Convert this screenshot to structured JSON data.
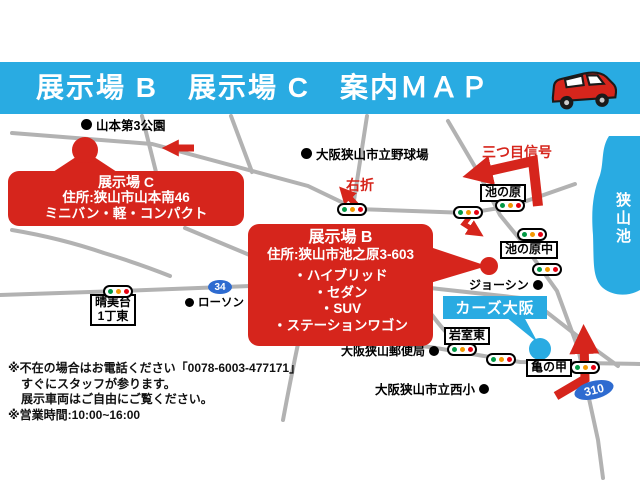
{
  "colors": {
    "brand_blue": "#29abe2",
    "map_red": "#d6251c",
    "road_gray": "#b2b2b2",
    "badge_blue": "#2e6bd0"
  },
  "header": {
    "title": "展示場 B　展示場 C　案内ＭＡＰ"
  },
  "callouts": {
    "c": {
      "title": "展示場 C",
      "address": "住所:狭山市山本南46",
      "types": "ミニバン・軽・コンパクト"
    },
    "b": {
      "title": "展示場 B",
      "address": "住所:狭山市池之原3-603",
      "types": [
        "・ハイブリッド",
        "・セダン",
        "・SUV",
        "・ステーションワゴン"
      ]
    }
  },
  "shop": {
    "name": "カーズ大阪"
  },
  "landmarks": {
    "yamamoto_park": "山本第3公園",
    "ballpark": "大阪狭山市立野球場",
    "lawson": "ローソン",
    "joshin": "ジョーシン",
    "post_office": "大阪狭山郵便局",
    "elementary_school": "大阪狭山市立西小",
    "lake": "狭山池"
  },
  "intersections": {
    "ikenohara": "池の原",
    "ikenohara_naka": "池の原中",
    "harumidai_line1": "晴美台",
    "harumidai_line2": "1丁東",
    "iwamuro_higashi": "岩室東",
    "kamenoko": "亀の甲"
  },
  "directions": {
    "third_signal": "三つ目信号",
    "turn_right": "右折"
  },
  "routes": {
    "route34": "34",
    "route310": "310"
  },
  "notes": {
    "line1": "※不在の場合はお電話ください「0078-6003-477171」",
    "line2": "すぐにスタッフが参ります。",
    "line3": "展示車両はご自由にご覧ください。",
    "line4": "※営業時間:10:00~16:00"
  }
}
